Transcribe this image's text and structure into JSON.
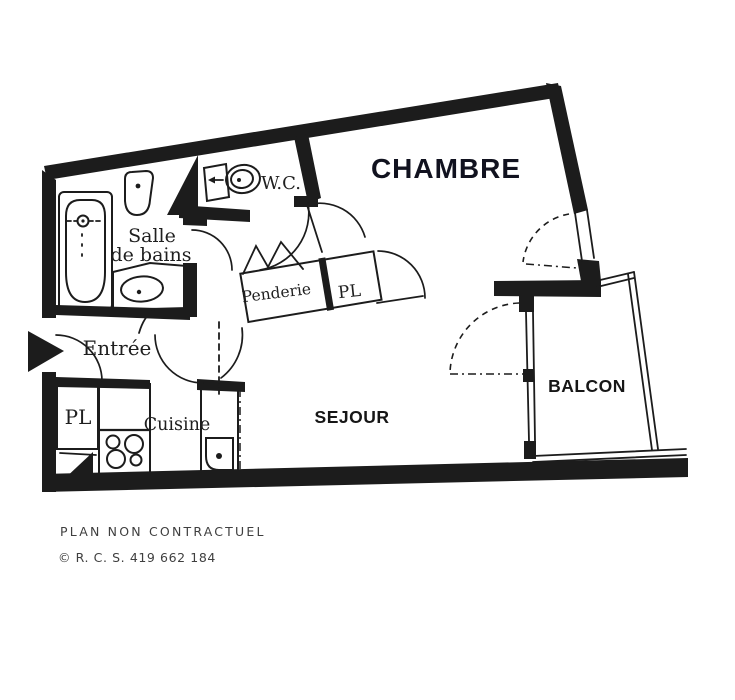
{
  "rooms": {
    "chambre": "CHAMBRE",
    "sejour": "SEJOUR",
    "balcon": "BALCON",
    "wc": "W.C.",
    "salle_de_bains_line1": "Salle",
    "salle_de_bains_line2": "de bains",
    "entree": "Entrée",
    "cuisine": "Cuisine",
    "penderie": "Penderie",
    "pl_hall": "PL",
    "pl_kitchen": "PL"
  },
  "footer": {
    "line1": "PLAN NON CONTRACTUEL",
    "line2": "© R. C. S. 419 662 184"
  },
  "colors": {
    "ink": "#1c1c1c",
    "paper": "#ffffff",
    "chambre_text": "#11121f",
    "footer_text": "#3f3f3f"
  }
}
